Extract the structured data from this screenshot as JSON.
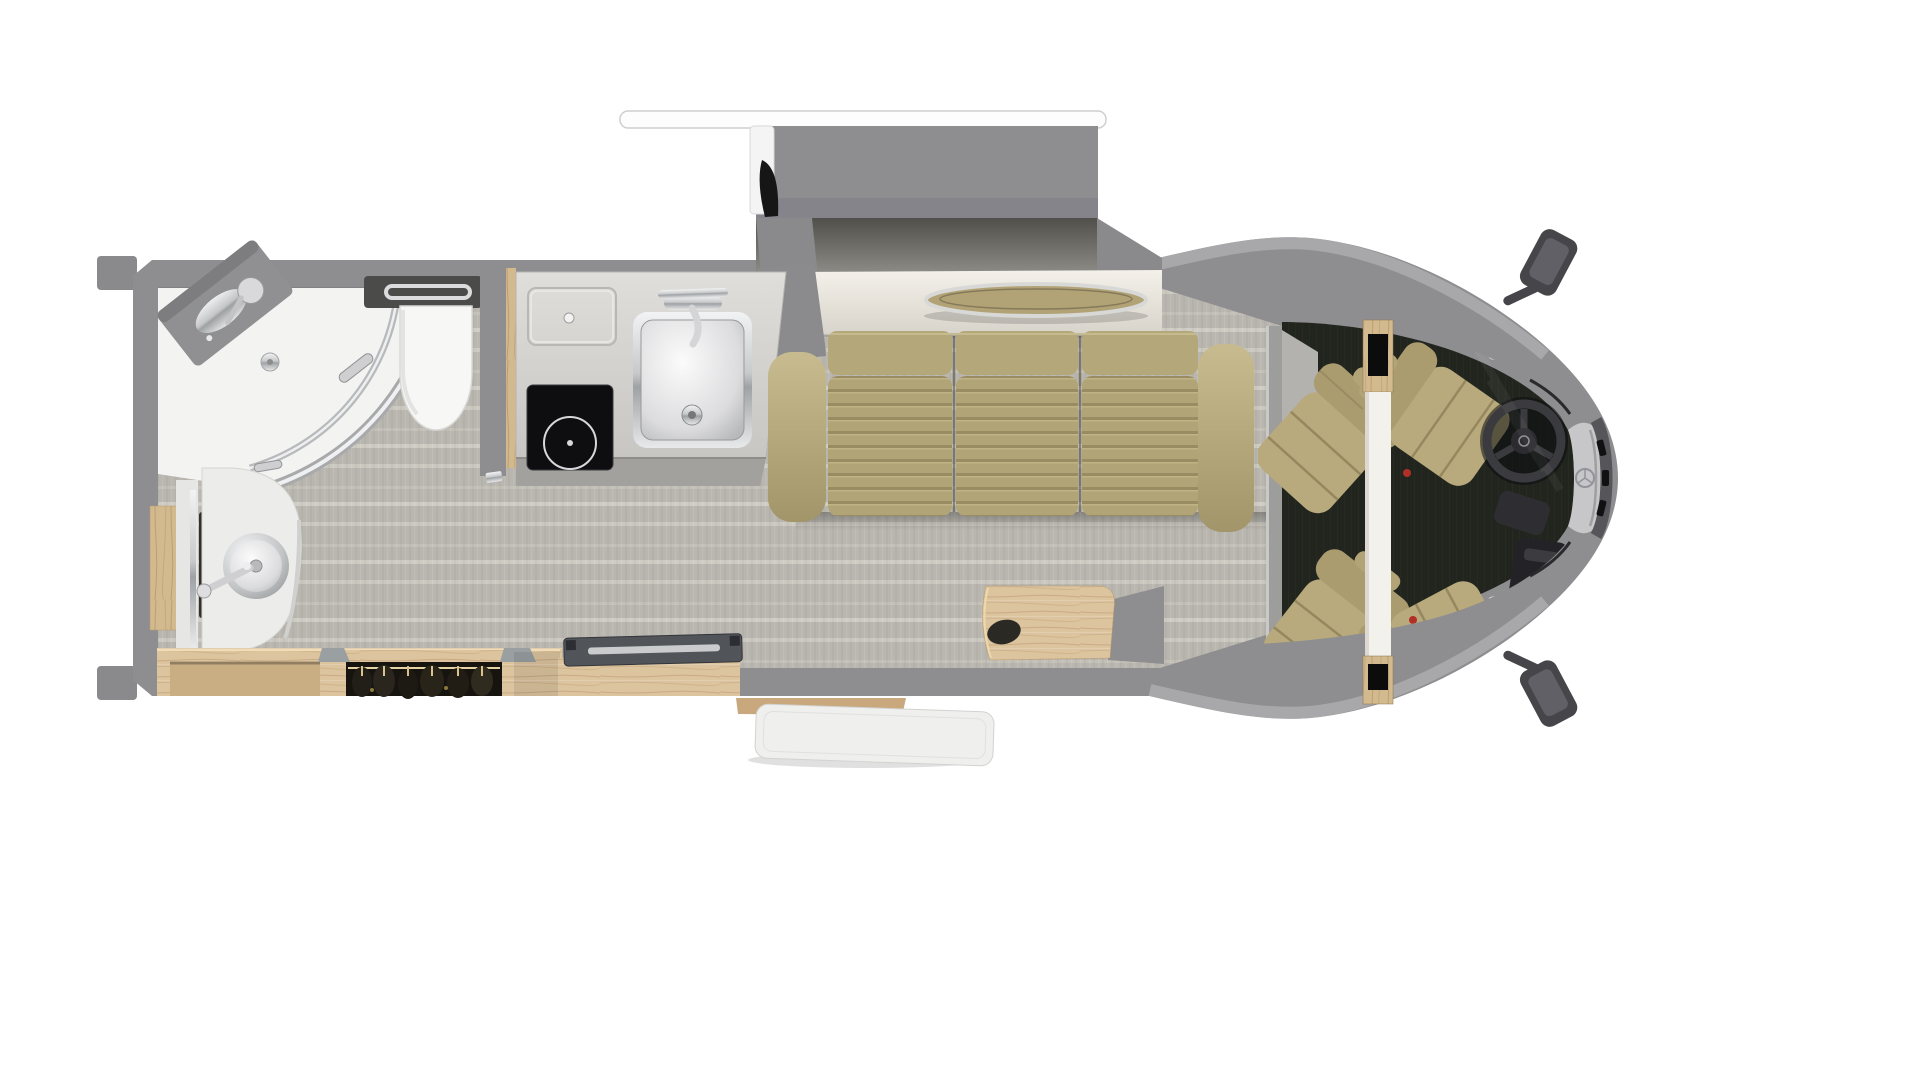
{
  "meta": {
    "type": "3d-floorplan-rendering",
    "subject": "Class B+ motorhome floor plan, top-down cutaway view",
    "orientation": "vehicle nose points right; slide-out extends from top wall",
    "visible_text": "none"
  },
  "palette": {
    "background": "#ffffff",
    "wall_gray": "#8e8e90",
    "roof_edge": "#a8a8aa",
    "floor_base": "#b9b6af",
    "floor_band": "#cbc8c0",
    "cab_floor": "#22251e",
    "sofa_tan": "#b4a87b",
    "seat_tan": "#b8aa7c",
    "wood_light": "#dcc49e",
    "wood_mid": "#c8a87c",
    "cream_ledge": "#f2efe8",
    "counter_gray": "#d6d4d0",
    "cooktop_black": "#0e0e10",
    "chrome": "#c7c9cb",
    "bathroom_white": "#f3f3f2",
    "tv_gray": "#515459",
    "wardrobe_dark": "#17140f",
    "table_wood": "#b2a377",
    "steering_dark": "#3b3b3f",
    "hood_gray": "#c7c7c9",
    "awning_white": "#fdfdfd"
  },
  "slide_out": {
    "label": "sofa slide-out",
    "items": [
      "awning-rail",
      "slide-box",
      "awning-arm",
      "back-ledge",
      "inset-oval-table"
    ]
  },
  "living_area": {
    "sofa": {
      "type": "three-cushion sofa",
      "cushions": 3,
      "color_name": "tan"
    },
    "flooring": "gray striped vinyl plank"
  },
  "kitchen": {
    "items": [
      "countertop",
      "flip-up-counter-lid",
      "induction-cooktop",
      "square-stainless-sink",
      "sink-faucet"
    ],
    "burner_count": 1
  },
  "bathroom": {
    "items": [
      "corner-shower",
      "curved-glass-shower-door",
      "shower-drain",
      "corner-shelf-with-shower-head",
      "toilet",
      "towel-bar",
      "vanity-counter",
      "round-vessel-sink",
      "vanity-faucet",
      "wood-backsplash-panel",
      "pocket-door-track"
    ]
  },
  "storage": {
    "items": [
      "base-cabinet",
      "wardrobe-with-hanging-clothes",
      "tv-cabinet",
      "tv-lift-panel",
      "bedside-cabinet"
    ],
    "hanger_count": 6
  },
  "entry": {
    "items": [
      "entry-step",
      "open-entry-door"
    ]
  },
  "cab": {
    "seats": [
      {
        "name": "swivel-captain-chair-rear-left"
      },
      {
        "name": "swivel-captain-chair-rear-right"
      },
      {
        "name": "driver-seat"
      },
      {
        "name": "passenger-seat"
      }
    ],
    "items": [
      "seat-divider-console",
      "steering-wheel",
      "dashboard-console",
      "windshield",
      "hood",
      "grille",
      "emblem",
      "side-mirror-top",
      "side-mirror-bottom"
    ]
  },
  "counts": {
    "captain_chairs": 4,
    "sofa_cushions": 3,
    "sinks": 2,
    "cooktop_burners": 1
  }
}
